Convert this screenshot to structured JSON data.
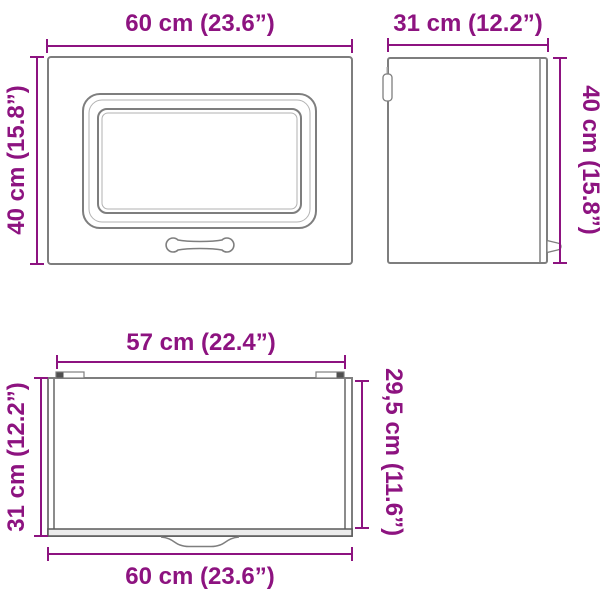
{
  "product": {
    "type": "wall-cabinet-dimension-diagram"
  },
  "colors": {
    "dimension_accent": "#8d1380",
    "outline_gray": "#7e7e7e",
    "outline_light_gray": "#b2b2b2",
    "detail_dark_gray": "#4f4f4f",
    "background": "#ffffff"
  },
  "dimensions": {
    "front": {
      "width": "60 cm (23.6”)",
      "height": "40 cm (15.8”)"
    },
    "side": {
      "depth": "31 cm (12.2”)",
      "height": "40 cm (15.8”)"
    },
    "top": {
      "inner_width": "57 cm (22.4”)",
      "depth": "31 cm (12.2”)",
      "inner_depth": "29,5 cm (11.6”)",
      "width": "60 cm (23.6”)"
    }
  }
}
